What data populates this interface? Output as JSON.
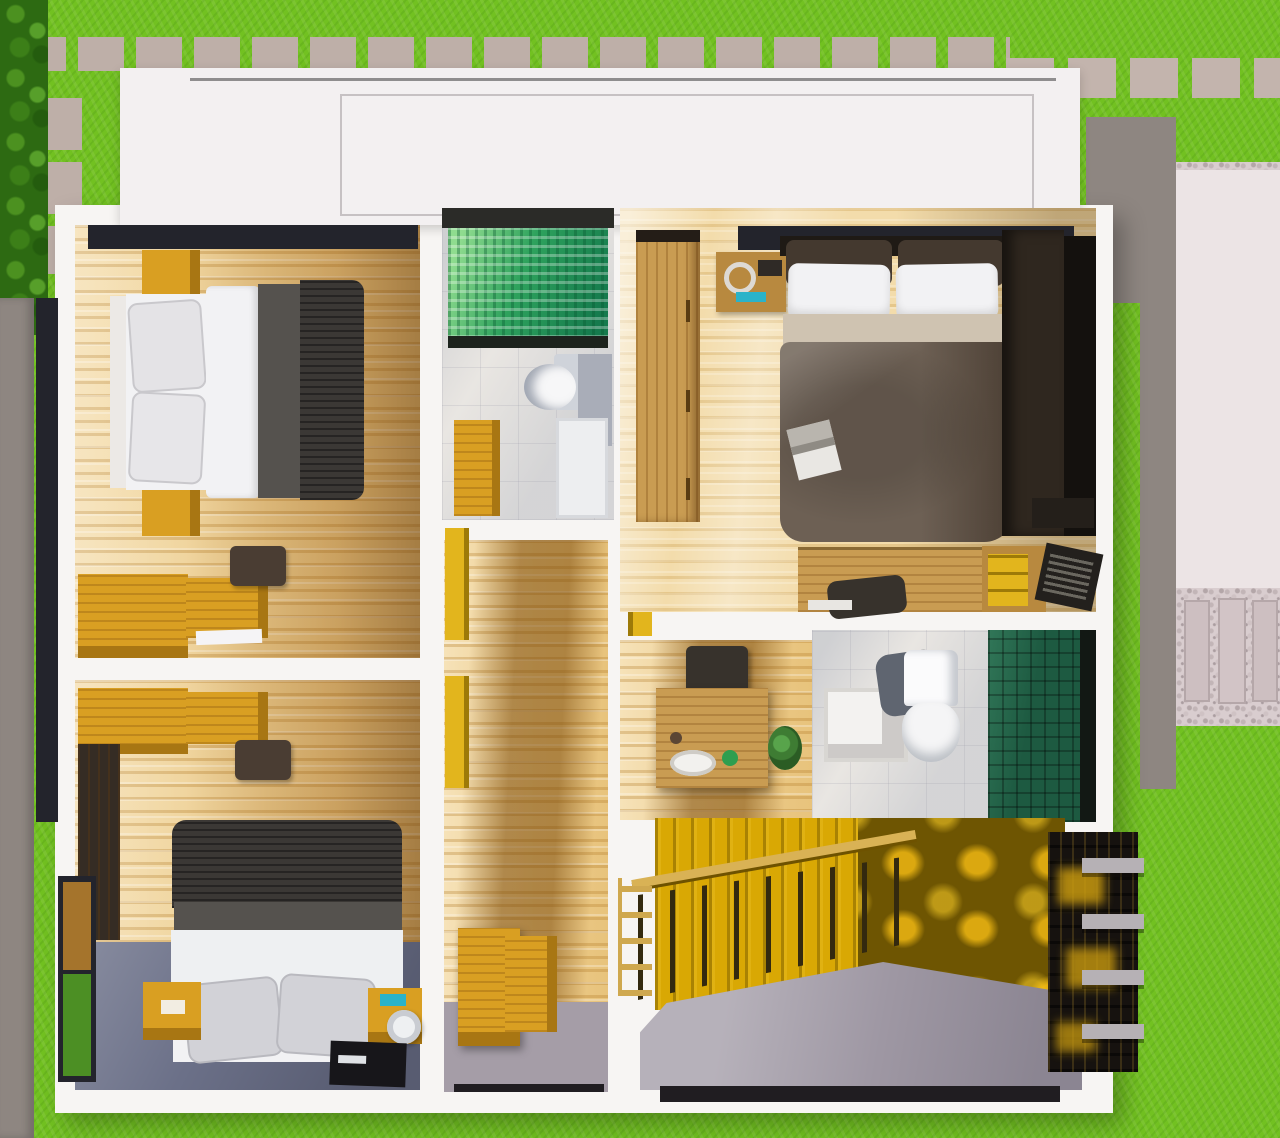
{
  "scene": {
    "title": "3D top-view floor plan render of house upper floor",
    "view": "top-down dollhouse cutaway",
    "rooms": [
      {
        "name": "bedroom-top-left",
        "furniture": [
          "double-bed",
          "white-pillows",
          "gray-blanket",
          "dark-ribbed-blanket",
          "nightstand",
          "nightstand",
          "corner-desk",
          "stool",
          "window-band"
        ]
      },
      {
        "name": "bathroom-1",
        "furniture": [
          "green-mosaic-shower",
          "glass-partition",
          "toilet",
          "amber-vanity",
          "white-fixture"
        ]
      },
      {
        "name": "master-bedroom",
        "furniture": [
          "double-bed",
          "headboard-cushions",
          "white-pillows",
          "brown-duvet",
          "magazine",
          "wood-wardrobe",
          "nightstand",
          "dark-wardrobe",
          "clothes-rack",
          "desk",
          "chair",
          "drawer-unit",
          "laptop",
          "window-band"
        ]
      },
      {
        "name": "corridor",
        "furniture": [
          "built-in-yellow-cabinets",
          "amber-dresser"
        ]
      },
      {
        "name": "bedroom-bottom-left",
        "furniture": [
          "double-bed",
          "gray-pillows",
          "desk",
          "stool",
          "dark-wardrobe",
          "nightstand",
          "nightstand",
          "speaker",
          "tv-unit",
          "window"
        ]
      },
      {
        "name": "wash-nook",
        "furniture": [
          "wash-counter",
          "sink",
          "plant",
          "stool"
        ]
      },
      {
        "name": "bathroom-2",
        "furniture": [
          "white-vanity",
          "toilet",
          "dark-green-tiled-shower",
          "glass-wall"
        ]
      },
      {
        "name": "stairwell",
        "furniture": [
          "golden-feature-wall",
          "wood-railing",
          "balusters",
          "gray-landing",
          "louver-screen",
          "pergola-beams"
        ]
      }
    ],
    "exterior": [
      "lawn",
      "hedge-row",
      "paver-walkway-top",
      "paver-walkway-left",
      "paver-walkway-right",
      "boundary-wall",
      "concrete-pad",
      "gravel-path",
      "flat-white-roof"
    ]
  },
  "palette": {
    "grass": "#72c121",
    "hedge": "#2d6a12",
    "paver": "#beafa8",
    "boundaryWall": "#8e8681",
    "roof": "#f3f0f1",
    "wall": "#f7f5f3",
    "windowDark": "#23242c",
    "glassDark": "#1d231d",
    "woodAmber": "#d99f22",
    "amberDark": "#a87613",
    "woodMid": "#c99c52",
    "woodDark": "#352c24",
    "bedWhite": "#f2f2f4",
    "pillowGray": "#d2d2d7",
    "blanketGray": "#55524e",
    "blanketDark": "#3b3835",
    "sheetBeige": "#cfc3b1",
    "duvetBrown": "#6d6054",
    "headboardBrown": "#44392f",
    "headboardBand": "#1f1a15",
    "marble": "#e9e6e2",
    "tankGray": "#cfd3da",
    "grayPanel": "#a9adb8",
    "toiletShadow": "#5f6570",
    "mosaicGreen": "#3aa95f",
    "greenTileDark": "#1d5a41",
    "slateFloor": "#6b7088",
    "yellowWall": "#d9a804",
    "yellowShade": "#6e5502",
    "yellowGlow": "#c89a10",
    "landing": "#9e97a3",
    "landingEdge": "#201d21",
    "louver": "#16120f",
    "beam": "#b6b1b5",
    "path": "#ece4e5",
    "gravel": "#d9cdcf",
    "grayFloor": "#a59da7",
    "cyan": "#2bb3c9",
    "laptop": "#23201d",
    "chair": "#37322c",
    "stool": "#4a3d33",
    "tv": "#17161a",
    "paperWhite": "#f5f4f6",
    "railWood": "#d9b255"
  }
}
